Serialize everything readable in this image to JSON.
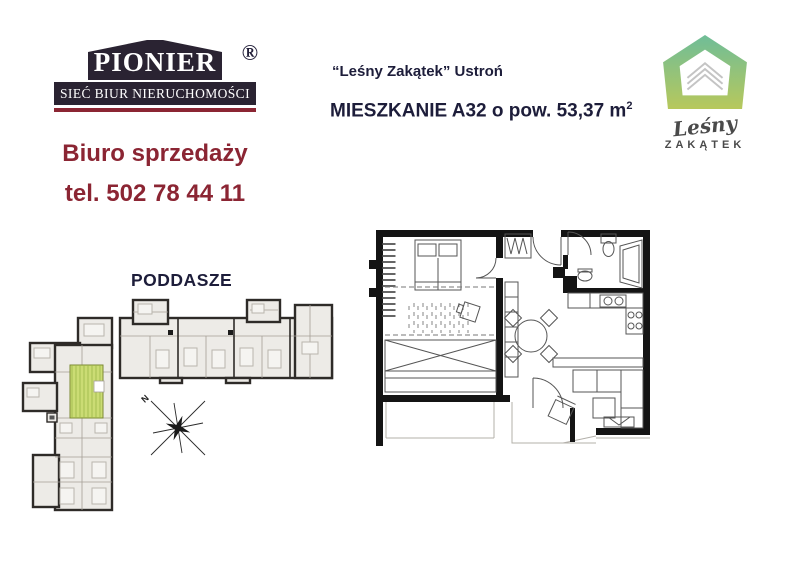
{
  "pionier_logo": {
    "name": "PIONIER",
    "registered": "®",
    "tagline": "SIEĆ BIUR NIERUCHOMOŚCI",
    "bg_color": "#2a2332",
    "underline_color": "#8b2533"
  },
  "sales_office": {
    "line1": "Biuro sprzedaży",
    "line2": "tel. 502 78 44 11",
    "text_color": "#8b2533"
  },
  "listing_header": {
    "project_line": "“Leśny Zakątek” Ustroń",
    "unit_line": "MIESZKANIE A32 o pow. 53,37 m",
    "area_exponent": "2",
    "text_color": "#1d1d3a"
  },
  "lesny_logo": {
    "script_text": "Leśny",
    "caps_text": "ZAKĄTEK",
    "gradient_top": "#6fbd98",
    "gradient_bottom": "#b7c85c",
    "text_color": "#4a4a4a"
  },
  "floor_plan_overview": {
    "floor_label": "PODDASZE",
    "highlighted_unit_color": "#cbdc74",
    "compass_label": "N"
  }
}
